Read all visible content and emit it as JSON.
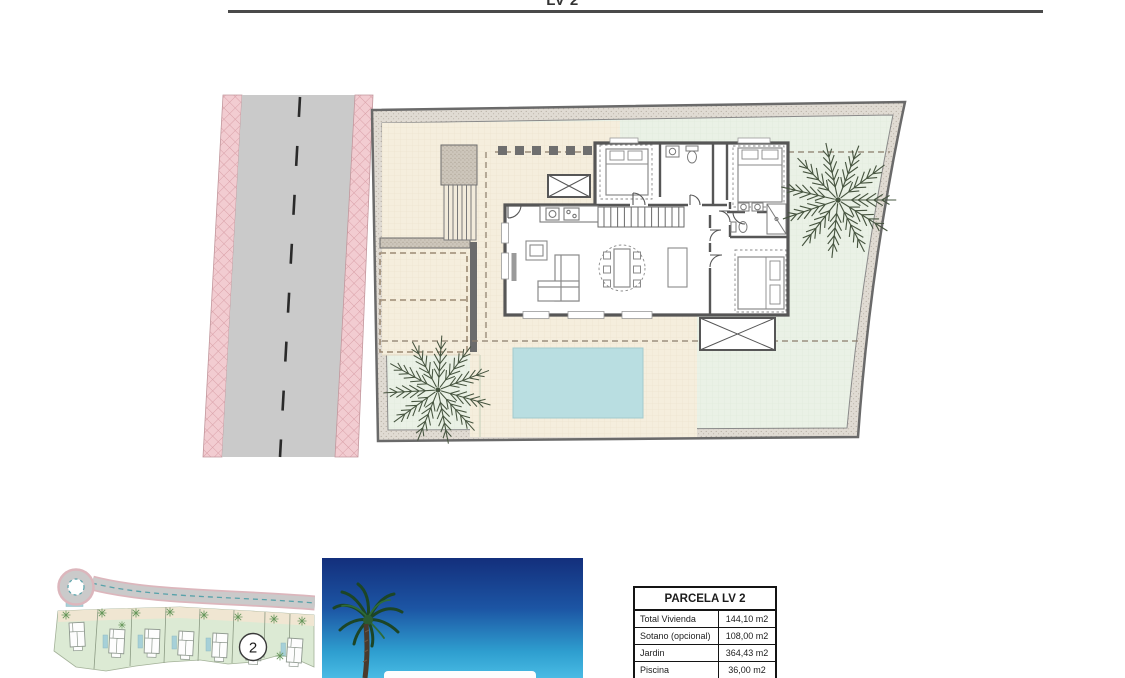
{
  "header": {
    "title": "LV 2"
  },
  "overview_map": {
    "plot_marker_label": "2"
  },
  "info_table": {
    "title": "PARCELA LV 2",
    "rows": [
      {
        "label": "Total Vivienda",
        "value": "144,10 m2"
      },
      {
        "label": "Sotano (opcional)",
        "value": "108,00 m2"
      },
      {
        "label": "Jardin",
        "value": "364,43 m2"
      },
      {
        "label": "Piscina",
        "value": "36,00 m2"
      }
    ]
  },
  "icons": {
    "plan_palm_tree": "palm-tree-icon",
    "photo_palm_tree": "palm-tree-icon",
    "overview_tree": "tree-icon",
    "stairs": "stairs-icon",
    "crossed_box": "skylight-icon"
  },
  "colors": {
    "road": "#cacaca",
    "sidewalk_pink": "#f2ccd1",
    "terrace_cream": "#f5eedd",
    "garden_mint": "#eaf1e6",
    "pool_blue": "#b9dee1",
    "wall": "#565656",
    "sky_top": "#132f7c",
    "sky_bottom": "#49bbe4",
    "map_plot_green": "#dcead4"
  }
}
